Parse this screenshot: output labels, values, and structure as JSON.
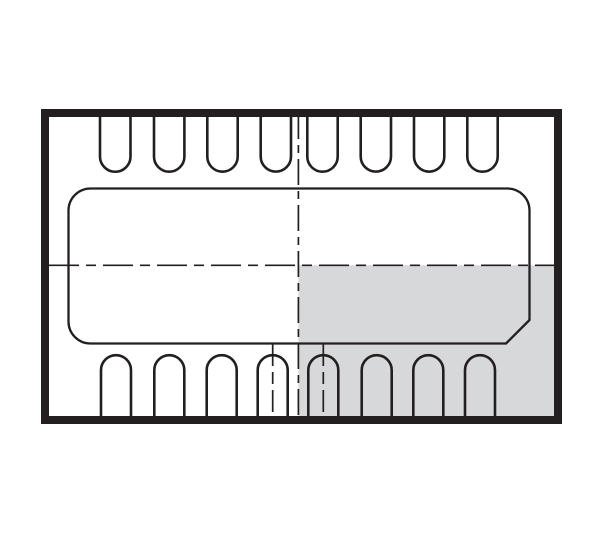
{
  "figure": {
    "kind": "ic-package-outline-top-view",
    "pin_count_top": 8,
    "pin_count_bottom": 8,
    "shaded_quadrant": "bottom-right",
    "exposed_pad_chamfer_corner": "bottom-right"
  },
  "colors": {
    "line": "#231f20",
    "shaded_fill": "#d7d8d9",
    "background": "#ffffff"
  }
}
